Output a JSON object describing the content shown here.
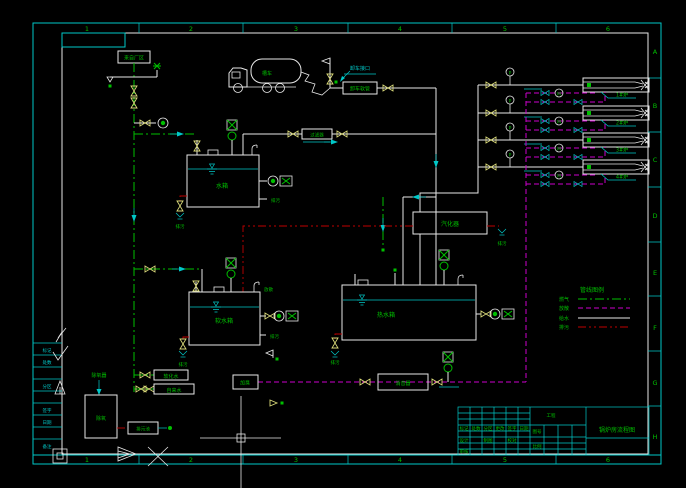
{
  "colors": {
    "bg": "#000000",
    "white": "#e8e8e8",
    "cyan": "#00c8c8",
    "green": "#00bf00",
    "yellow": "#d8d878",
    "magenta": "#cc00cc",
    "red": "#bf0000"
  },
  "zones": {
    "top": [
      "1",
      "2",
      "3",
      "4",
      "5",
      "6"
    ],
    "bottom": [
      "1",
      "2",
      "3",
      "4",
      "5",
      "6"
    ],
    "right": [
      "A",
      "B",
      "C",
      "D",
      "E",
      "F",
      "G",
      "H"
    ]
  },
  "labels": {
    "supply": "来自厂区",
    "truck": "槽车",
    "unload_note": "卸车接口",
    "hose": "卸车软管",
    "filter": "过滤器",
    "tank1": "水箱",
    "tank2": "软水箱",
    "tank3": "热水箱",
    "vaporizer": "汽化器",
    "odorizer": "加臭",
    "silencer": "消音器",
    "deaerator_note": "除氧器",
    "deaerator": "除氧",
    "drain_pit": "排污池",
    "soft_water": "软化水",
    "city_water": "自来水",
    "drain": "排污",
    "vent": "放散",
    "p": "P",
    "m": "M"
  },
  "burners": [
    {
      "label": "1#炉"
    },
    {
      "label": "2#炉"
    },
    {
      "label": "3#炉"
    },
    {
      "label": "4#炉"
    }
  ],
  "legend": {
    "title": "管线图例",
    "rows": [
      {
        "label": "燃气",
        "style": "green-dashdot"
      },
      {
        "label": "放散",
        "style": "magenta-dash"
      },
      {
        "label": "给水",
        "style": "white-solid"
      },
      {
        "label": "排污",
        "style": "red-dashdot"
      }
    ]
  },
  "revision": {
    "rows": [
      "标记",
      "处数",
      "分区",
      "签字",
      "日期",
      "备注"
    ]
  },
  "title_block": {
    "title": "锅炉房流程图",
    "cells": [
      "标记",
      "处数",
      "分区",
      "更改",
      "签字",
      "日期",
      "设计",
      "制图",
      "校对",
      "审核",
      "工程",
      "图号",
      "比例"
    ]
  }
}
